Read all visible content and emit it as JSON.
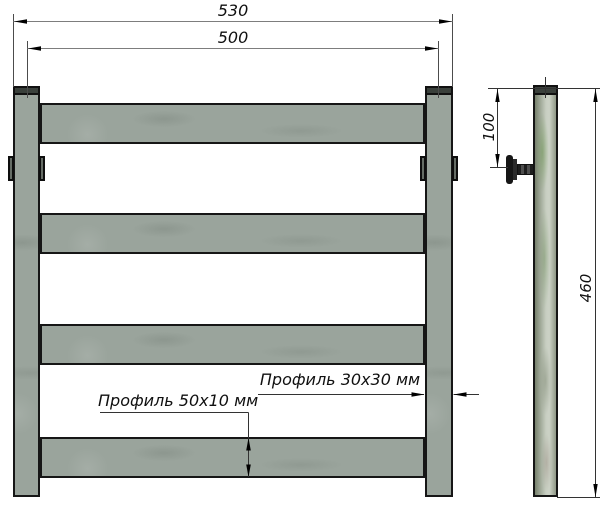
{
  "dimensions": {
    "overall_width": "530",
    "post_spacing": "500",
    "bracket_offset": "100",
    "frame_height": "460"
  },
  "labels": {
    "crossbar_profile": "Профиль 50x10 мм",
    "post_profile": "Профиль 30x30 мм"
  },
  "colors": {
    "metal_fill": "#9aa49c",
    "outline": "#161616",
    "cap_fill": "#3a403b",
    "dimension_line": "#4c4c4c",
    "background": "#ffffff"
  }
}
